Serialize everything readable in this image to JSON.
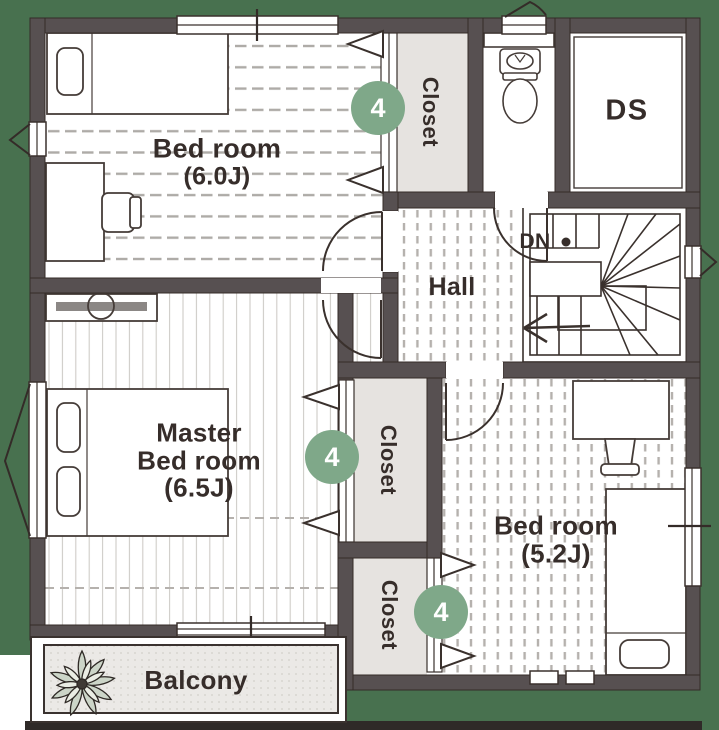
{
  "plan": {
    "colors": {
      "background": "#48714F",
      "wall": "#575051",
      "badge": "#7FA889",
      "closet_fill": "#E6E3E0"
    },
    "rooms": {
      "bedroom_1": {
        "name": "Bed room",
        "size": "(6.0J)"
      },
      "master_bedroom": {
        "line1": "Master",
        "line2": "Bed room",
        "size": "(6.5J)"
      },
      "bedroom_2": {
        "name": "Bed room",
        "size": "(5.2J)"
      },
      "hall": {
        "label": "Hall"
      },
      "duct_space": {
        "label": "DS"
      },
      "balcony": {
        "label": "Balcony"
      },
      "closet_top": {
        "label": "Closet",
        "badge": "4"
      },
      "closet_middle": {
        "label": "Closet",
        "badge": "4"
      },
      "closet_bottom": {
        "label": "Closet",
        "badge": "4"
      },
      "stairs": {
        "down_label": "DN"
      }
    }
  }
}
